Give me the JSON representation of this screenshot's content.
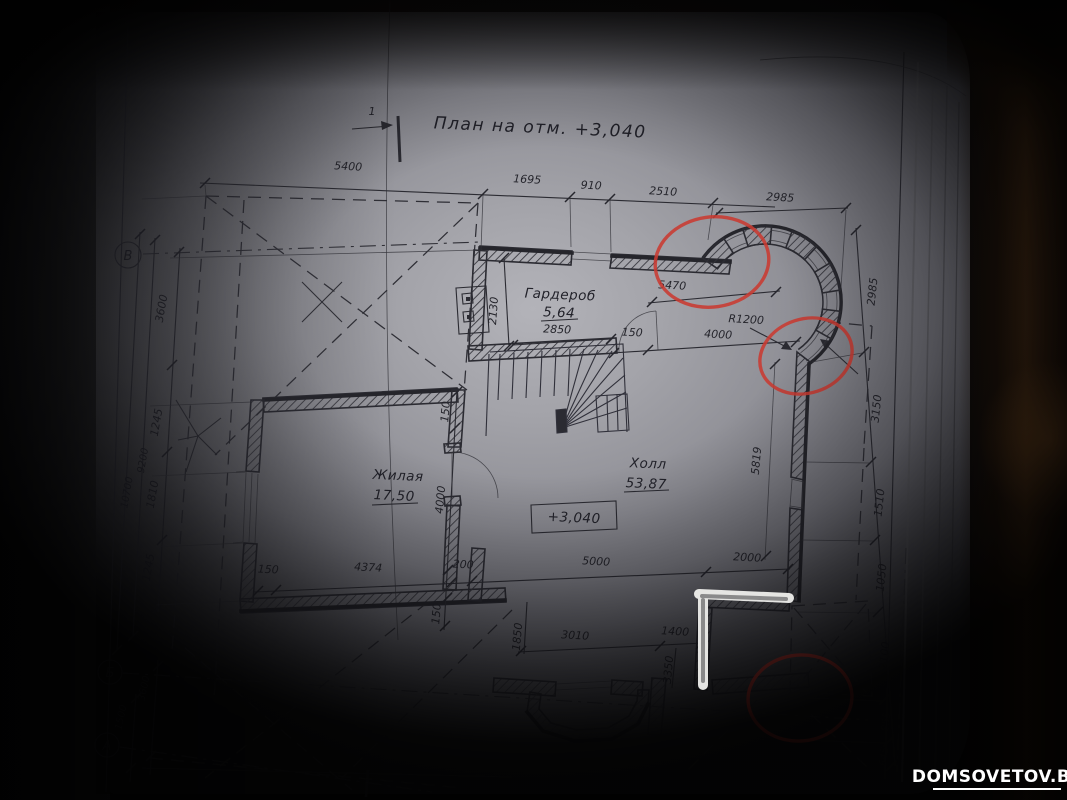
{
  "title": {
    "section_number": "1",
    "text": "План на отм. +3,040"
  },
  "axes": {
    "top": "В",
    "middle": "Б",
    "bottom": "А"
  },
  "rooms": {
    "garderob": {
      "name": "Гардероб",
      "area": "5,64",
      "width": "2850"
    },
    "zhilaya": {
      "name": "Жилая",
      "area": "17,50"
    },
    "holl": {
      "name": "Холл",
      "area": "53,87"
    },
    "elevation": "+3,040",
    "radius": "R1200"
  },
  "dims": {
    "top_chain": [
      "5400",
      "1695",
      "910",
      "2510",
      "2985"
    ],
    "right_chain": [
      "2985",
      "3150",
      "1510",
      "1050",
      "2100",
      "855",
      "645"
    ],
    "left_outer": [
      "10700",
      "9200"
    ],
    "left_chain": [
      "3600",
      "1245",
      "1810",
      "1245"
    ],
    "left_bottom": [
      "3600",
      "1500"
    ],
    "garderob_chain": [
      "2130",
      "150",
      "4000",
      "5470"
    ],
    "mid_chain": [
      "150",
      "4000",
      "150"
    ],
    "bottom_chain1": [
      "150",
      "4374",
      "200",
      "5000",
      "2000"
    ],
    "bottom_chain2": [
      "1850",
      "3010",
      "1400",
      "3350"
    ],
    "holl_vert": [
      "5819"
    ]
  },
  "photo": {
    "watermark": "DOMSOVETOV.BY"
  },
  "colors": {
    "annotation_red": "#c93a31",
    "marker_white": "#efefec",
    "paper_gray": "#a9a9af",
    "ink": "#2a2a31",
    "table_brown": "#3a2410"
  }
}
